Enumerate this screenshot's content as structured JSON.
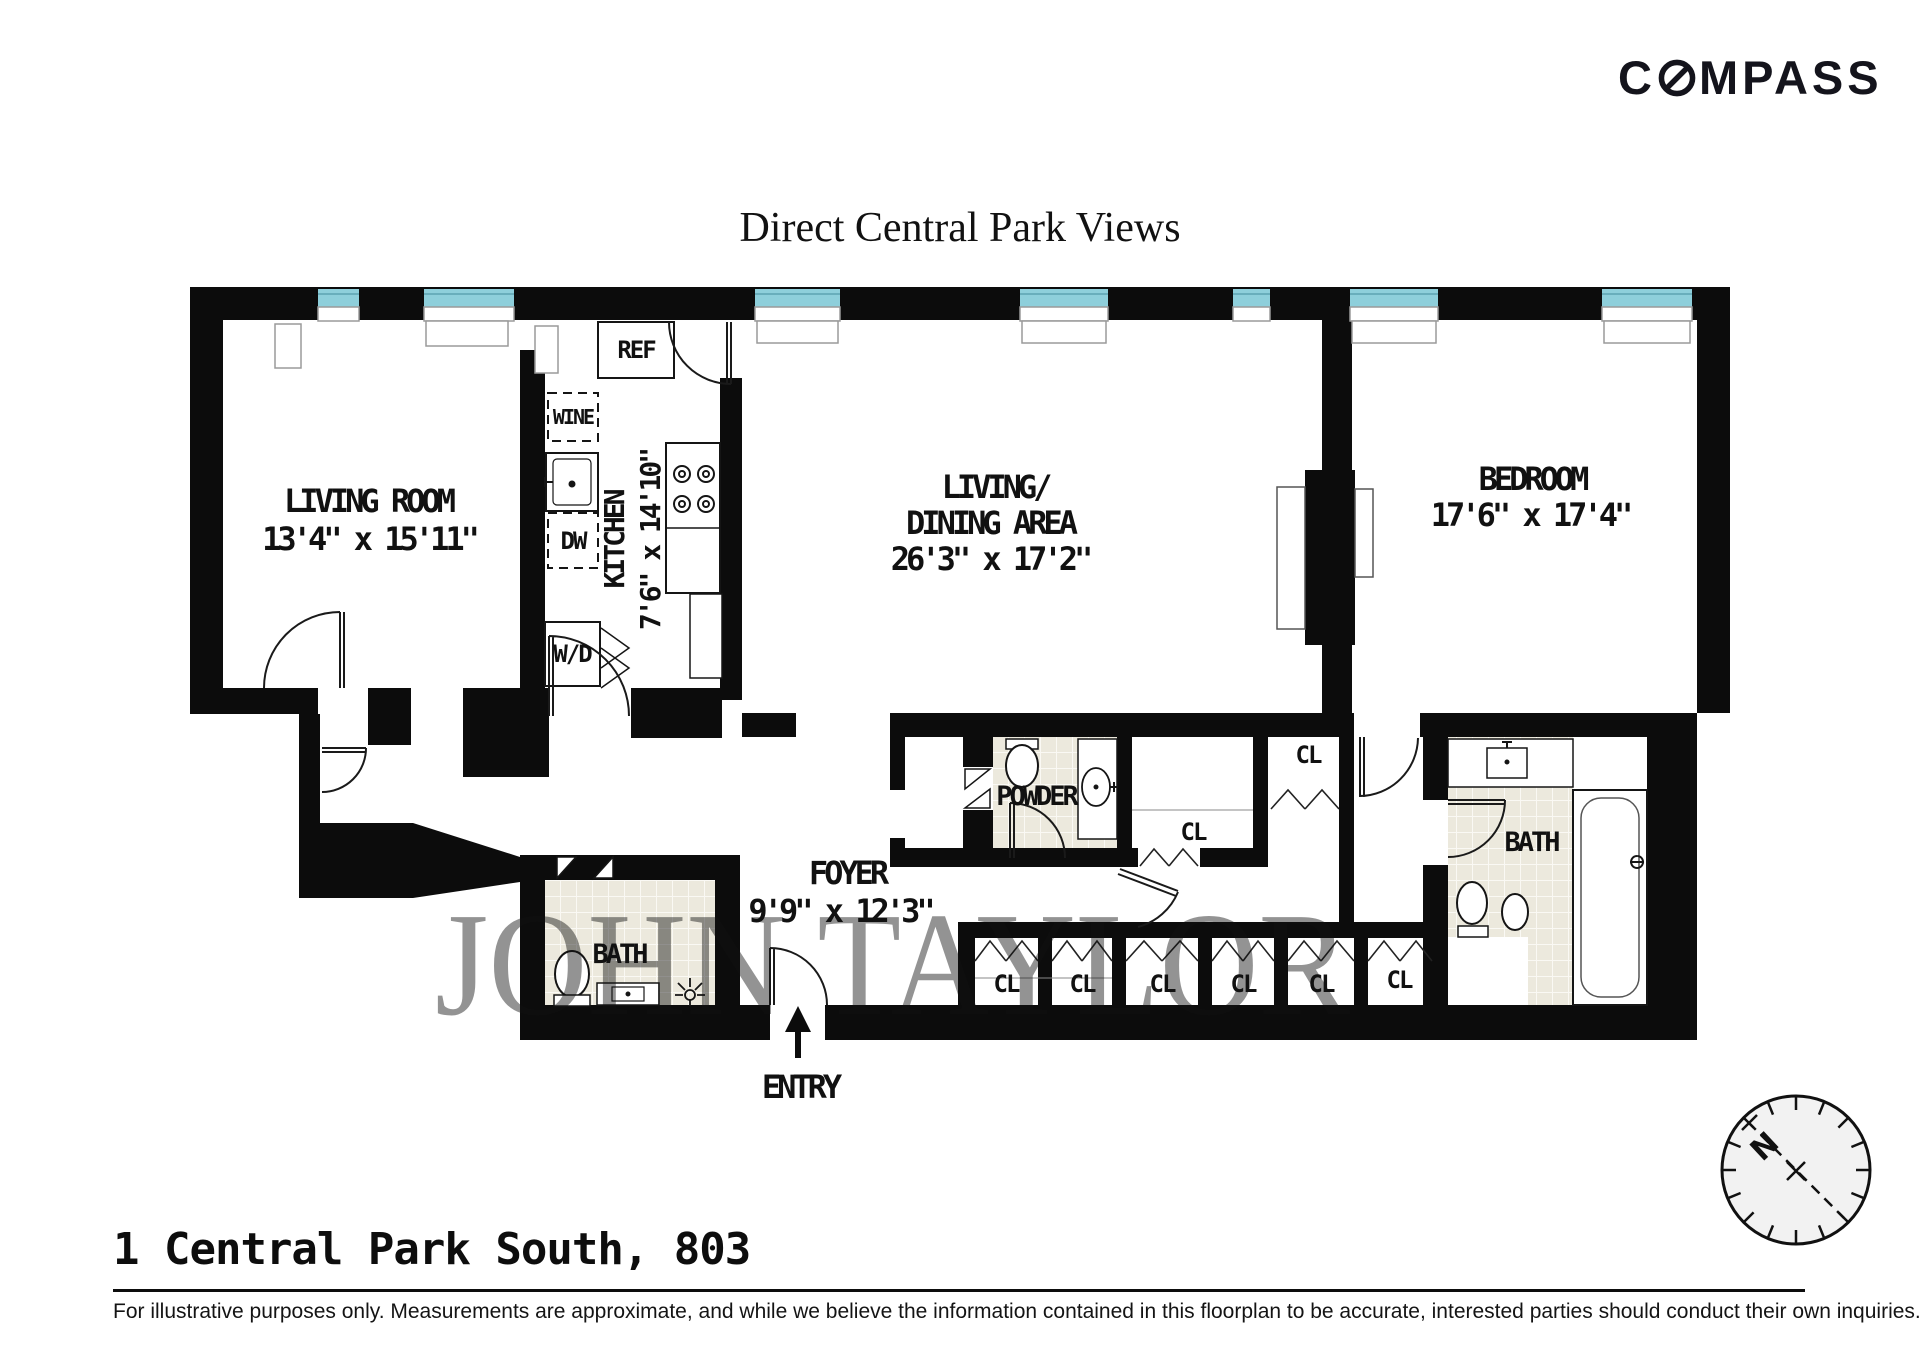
{
  "logo": {
    "text_c": "C",
    "text_rest": "MPASS",
    "full": "COMPASS"
  },
  "title": "Direct Central Park Views",
  "floorplan": {
    "rooms": {
      "living_room": {
        "name": "LIVING ROOM",
        "dims": "13'4\" x 15'11\""
      },
      "kitchen": {
        "name": "KITCHEN",
        "dims": "7'6\" x 14'10\""
      },
      "living_dining": {
        "name_line1": "LIVING/",
        "name_line2": "DINING AREA",
        "dims": "26'3\" x 17'2\""
      },
      "bedroom": {
        "name": "BEDROOM",
        "dims": "17'6\" x 17'4\""
      },
      "foyer": {
        "name": "FOYER",
        "dims": "9'9\" x 12'3\""
      },
      "powder_room": {
        "name": "POWDER"
      },
      "hall_bath": {
        "name": "BATH"
      },
      "master_bath": {
        "name": "BATH"
      }
    },
    "labels": {
      "entry": "ENTRY",
      "ref": "REF",
      "wine": "WINE",
      "dishwasher": "DW",
      "washer_dryer": "W/D"
    },
    "closets": [
      "CL",
      "CL",
      "CL",
      "CL",
      "CL",
      "CL",
      "CL",
      "CL"
    ],
    "compass_rose_north": "N",
    "watermark": "JOHN TAYLOR"
  },
  "footer": {
    "address": "1 Central Park South, 803",
    "disclaimer": "For illustrative purposes only.  Measurements are approximate, and while we believe the information contained in this floorplan to be accurate, interested parties should conduct their own inquiries."
  },
  "colors": {
    "wall": "#0c0c0c",
    "window": "#8ecfdb",
    "tile": "#ece9dd"
  }
}
